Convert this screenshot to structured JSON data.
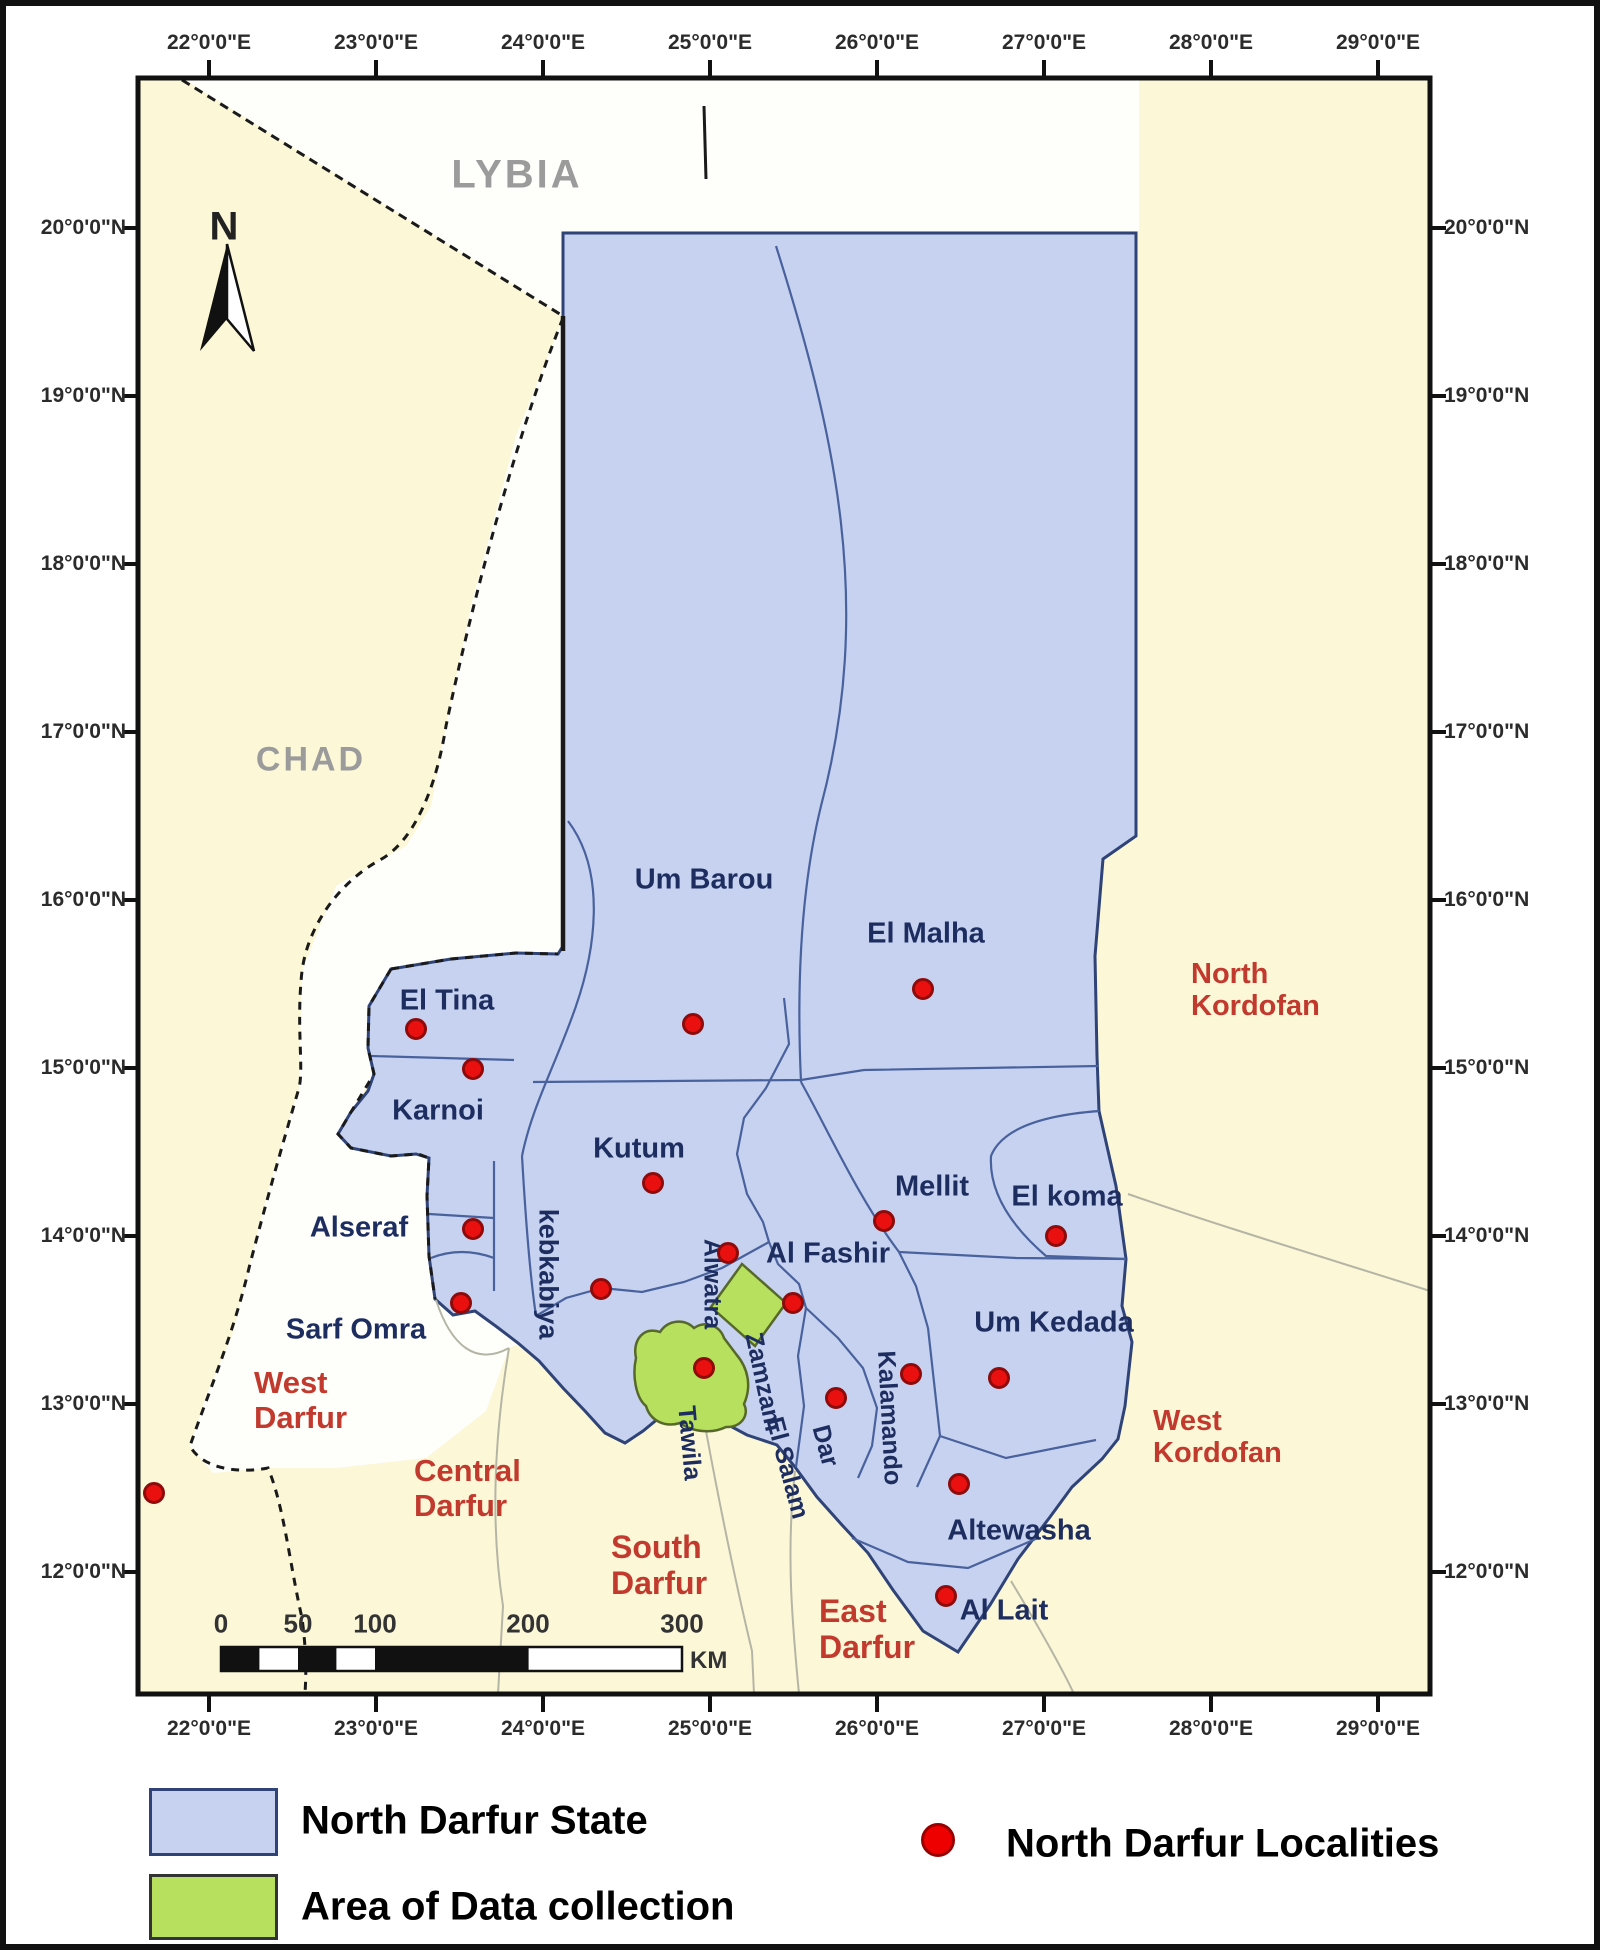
{
  "axes": {
    "top": [
      "22°0'0\"E",
      "23°0'0\"E",
      "24°0'0\"E",
      "25°0'0\"E",
      "26°0'0\"E",
      "27°0'0\"E",
      "28°0'0\"E",
      "29°0'0\"E"
    ],
    "bottom": [
      "22°0'0\"E",
      "23°0'0\"E",
      "24°0'0\"E",
      "25°0'0\"E",
      "26°0'0\"E",
      "27°0'0\"E",
      "28°0'0\"E",
      "29°0'0\"E"
    ],
    "left": [
      "20°0'0\"N",
      "19°0'0\"N",
      "18°0'0\"N",
      "17°0'0\"N",
      "16°0'0\"N",
      "15°0'0\"N",
      "14°0'0\"N",
      "13°0'0\"N",
      "12°0'0\"N"
    ],
    "right": [
      "20°0'0\"N",
      "19°0'0\"N",
      "18°0'0\"N",
      "17°0'0\"N",
      "16°0'0\"N",
      "15°0'0\"N",
      "14°0'0\"N",
      "13°0'0\"N",
      "12°0'0\"N"
    ]
  },
  "compass": {
    "label": "N"
  },
  "countries": [
    {
      "name": "LYBIA",
      "x": 511,
      "y": 169,
      "size": 40
    },
    {
      "name": "CHAD",
      "x": 305,
      "y": 754,
      "size": 34
    }
  ],
  "regions": [
    {
      "lines": [
        "North",
        "Kordofan"
      ],
      "x": 1185,
      "y": 952,
      "size": 29
    },
    {
      "lines": [
        "West",
        "Kordofan"
      ],
      "x": 1147,
      "y": 1399,
      "size": 29
    },
    {
      "lines": [
        "West",
        "Darfur"
      ],
      "x": 248,
      "y": 1360,
      "size": 31
    },
    {
      "lines": [
        "Central",
        "Darfur"
      ],
      "x": 408,
      "y": 1448,
      "size": 31
    },
    {
      "lines": [
        "South",
        "Darfur"
      ],
      "x": 605,
      "y": 1524,
      "size": 32
    },
    {
      "lines": [
        "East",
        "Darfur"
      ],
      "x": 813,
      "y": 1588,
      "size": 32
    }
  ],
  "localities": {
    "labels": [
      {
        "text": "Um Barou",
        "x": 698,
        "y": 874,
        "size": 29,
        "rot": 0
      },
      {
        "text": "El Malha",
        "x": 920,
        "y": 928,
        "size": 29,
        "rot": 0
      },
      {
        "text": "El Tina",
        "x": 441,
        "y": 995,
        "size": 29,
        "rot": 0
      },
      {
        "text": "Karnoi",
        "x": 432,
        "y": 1105,
        "size": 29,
        "rot": 0
      },
      {
        "text": "Kutum",
        "x": 633,
        "y": 1143,
        "size": 29,
        "rot": 0
      },
      {
        "text": "Mellit",
        "x": 926,
        "y": 1181,
        "size": 29,
        "rot": 0
      },
      {
        "text": "El koma",
        "x": 1061,
        "y": 1191,
        "size": 29,
        "rot": 0
      },
      {
        "text": "Al Fashir",
        "x": 822,
        "y": 1248,
        "size": 29,
        "rot": 0
      },
      {
        "text": "Alseraf",
        "x": 353,
        "y": 1222,
        "size": 29,
        "rot": 0
      },
      {
        "text": "Sarf Omra",
        "x": 350,
        "y": 1324,
        "size": 29,
        "rot": 0
      },
      {
        "text": "Um Kedada",
        "x": 1048,
        "y": 1317,
        "size": 29,
        "rot": 0
      },
      {
        "text": "Altewasha",
        "x": 1013,
        "y": 1525,
        "size": 29,
        "rot": 0
      },
      {
        "text": "Al Lait",
        "x": 998,
        "y": 1605,
        "size": 29,
        "rot": 0
      },
      {
        "text": "kebkabiya",
        "x": 542,
        "y": 1268,
        "size": 27,
        "rot": 90
      },
      {
        "text": "Alwatra",
        "x": 706,
        "y": 1278,
        "size": 25,
        "rot": 90
      },
      {
        "text": "Zamzam",
        "x": 757,
        "y": 1376,
        "size": 25,
        "rot": 78
      },
      {
        "text": "Tawila",
        "x": 683,
        "y": 1437,
        "size": 25,
        "rot": 85
      },
      {
        "text": "El Salam",
        "x": 781,
        "y": 1462,
        "size": 25,
        "rot": 75
      },
      {
        "text": "Dar",
        "x": 819,
        "y": 1440,
        "size": 25,
        "rot": 75
      },
      {
        "text": "Kalamando",
        "x": 883,
        "y": 1412,
        "size": 25,
        "rot": 87
      }
    ],
    "dots": [
      {
        "x": 410,
        "y": 1023
      },
      {
        "x": 467,
        "y": 1063
      },
      {
        "x": 687,
        "y": 1018
      },
      {
        "x": 917,
        "y": 983
      },
      {
        "x": 647,
        "y": 1177
      },
      {
        "x": 878,
        "y": 1215
      },
      {
        "x": 1050,
        "y": 1230
      },
      {
        "x": 467,
        "y": 1223
      },
      {
        "x": 595,
        "y": 1283
      },
      {
        "x": 455,
        "y": 1297
      },
      {
        "x": 722,
        "y": 1247
      },
      {
        "x": 787,
        "y": 1297
      },
      {
        "x": 698,
        "y": 1362
      },
      {
        "x": 830,
        "y": 1392
      },
      {
        "x": 905,
        "y": 1368
      },
      {
        "x": 993,
        "y": 1372
      },
      {
        "x": 953,
        "y": 1478
      },
      {
        "x": 940,
        "y": 1590
      },
      {
        "x": 148,
        "y": 1487
      }
    ]
  },
  "scale_bar": {
    "ticks": [
      "0",
      "50",
      "100",
      "200",
      "300"
    ],
    "unit": "KM"
  },
  "legend": {
    "state_label": "North Darfur State",
    "area_label": "Area of Data collection",
    "localities_label": "North Darfur Localities"
  },
  "colors": {
    "state_fill": "#c6d2f0",
    "area_fill": "#b7e05e",
    "locality_dot": "#ea1010",
    "background_land": "#fbf7d7",
    "region_label": "#c23a2e"
  }
}
